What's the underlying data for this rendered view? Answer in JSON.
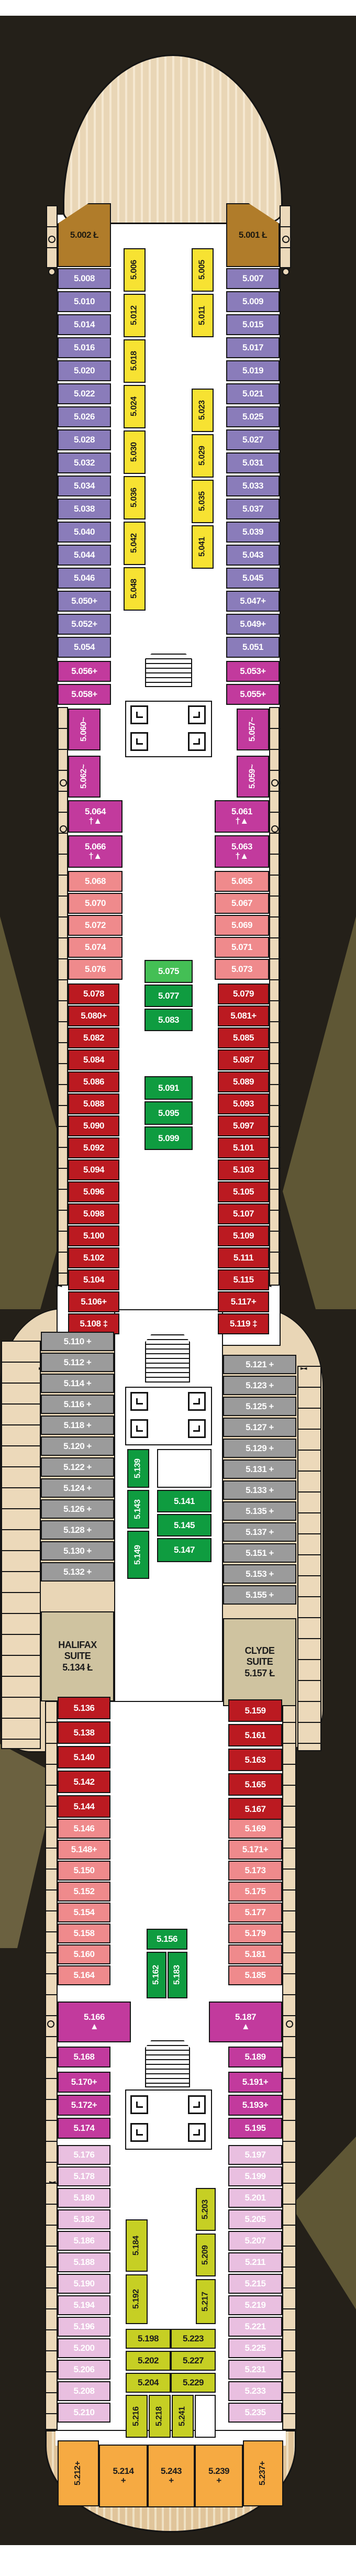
{
  "title": "Deck 5 cabin plan",
  "colors": {
    "background": "#242019",
    "background_art": "#5f5735",
    "hull_deck": "#e9d6b6",
    "hull_deck_stripe": "#f5e8d1",
    "suite_gold": "#b07c2a",
    "purple": "#8a7cba",
    "yellow": "#f7e232",
    "magenta": "#c23a9d",
    "salmon": "#ef8a8c",
    "red": "#bb1a21",
    "green_light": "#44bf55",
    "green": "#0f9c40",
    "gray": "#9b9b9b",
    "suite_beige": "#cfc3a0",
    "pink": "#e9bfe0",
    "chartreuse": "#c6cf24",
    "orange": "#f6aa42"
  },
  "symbols": {
    "lift_accessible": "Ł",
    "plus": "+",
    "tilde": "~",
    "dagger_triangle": "†▲",
    "triangle": "▲",
    "double_dagger": "‡"
  },
  "groups": {
    "brownL": {
      "cat": "brown",
      "items": [
        "5.002 Ł"
      ]
    },
    "brownR": {
      "cat": "brown",
      "items": [
        "5.001 Ł"
      ]
    },
    "yellowL": {
      "cat": "yellow",
      "items": [
        "5.006",
        "5.012",
        "5.018",
        "5.024",
        "5.030",
        "5.036",
        "5.042",
        "5.048"
      ]
    },
    "yellowR": {
      "cat": "yellow",
      "items": [
        "5.005",
        "5.011",
        "5.023",
        "5.029",
        "5.035",
        "5.041"
      ]
    },
    "purpleL": {
      "cat": "purple",
      "items": [
        "5.008",
        "5.010",
        "5.014",
        "5.016",
        "5.020",
        "5.022",
        "5.026",
        "5.028",
        "5.032",
        "5.034",
        "5.038",
        "5.040",
        "5.044",
        "5.046",
        "5.050+",
        "5.052+",
        "5.054"
      ]
    },
    "purpleR": {
      "cat": "purple",
      "items": [
        "5.007",
        "5.009",
        "5.015",
        "5.017",
        "5.019",
        "5.021",
        "5.025",
        "5.027",
        "5.031",
        "5.033",
        "5.037",
        "5.039",
        "5.043",
        "5.045",
        "5.047+",
        "5.049+",
        "5.051"
      ]
    },
    "mag1aL": {
      "cat": "magenta",
      "items": [
        "5.056+",
        "5.058+"
      ]
    },
    "mag1aR": {
      "cat": "magenta",
      "items": [
        "5.053+",
        "5.055+"
      ]
    },
    "mag1bL": {
      "cat": "magenta",
      "items": [
        "5.060~",
        "5.062~"
      ]
    },
    "mag1bR": {
      "cat": "magenta",
      "items": [
        "5.057~",
        "5.059~"
      ]
    },
    "mag1cL": {
      "cat": "magenta",
      "items": [
        "5.064\n†▲",
        "5.066\n†▲"
      ]
    },
    "mag1cR": {
      "cat": "magenta",
      "items": [
        "5.061\n†▲",
        "5.063\n†▲"
      ]
    },
    "sal1L": {
      "cat": "salmon",
      "items": [
        "5.068",
        "5.070",
        "5.072",
        "5.074",
        "5.076"
      ]
    },
    "sal1R": {
      "cat": "salmon",
      "items": [
        "5.065",
        "5.067",
        "5.069",
        "5.071",
        "5.073"
      ]
    },
    "red1L": {
      "cat": "red",
      "items": [
        "5.078",
        "5.080+",
        "5.082",
        "5.084",
        "5.086",
        "5.088",
        "5.090",
        "5.092",
        "5.094",
        "5.096",
        "5.098",
        "5.100",
        "5.102",
        "5.104",
        "5.106+",
        "5.108 ‡"
      ]
    },
    "red1R": {
      "cat": "red",
      "items": [
        "5.079",
        "5.081+",
        "5.085",
        "5.087",
        "5.089",
        "5.093",
        "5.097",
        "5.101",
        "5.103",
        "5.105",
        "5.107",
        "5.109",
        "5.111",
        "5.115",
        "5.117+",
        "5.119 ‡"
      ]
    },
    "green1a": {
      "cat": "greenl",
      "items": [
        "5.075"
      ]
    },
    "green1b": {
      "cat": "green",
      "items": [
        "5.077",
        "5.083"
      ]
    },
    "green1c": {
      "cat": "green",
      "items": [
        "5.091",
        "5.095",
        "5.099"
      ]
    },
    "grayL": {
      "cat": "gray",
      "items": [
        "5.110 +",
        "5.112 +",
        "5.114 +",
        "5.116 +",
        "5.118 +",
        "5.120 +",
        "5.122 +",
        "5.124 +",
        "5.126 +",
        "5.128 +",
        "5.130 +",
        "5.132 +"
      ]
    },
    "grayR": {
      "cat": "gray",
      "items": [
        "5.121 +",
        "5.123 +",
        "5.125 +",
        "5.127 +",
        "5.129 +",
        "5.131 +",
        "5.133 +",
        "5.135 +",
        "5.137 +",
        "5.151 +",
        "5.153 +",
        "5.155 +"
      ]
    },
    "green2L": {
      "cat": "green",
      "items": [
        "5.139",
        "5.143",
        "5.149"
      ]
    },
    "green2R": {
      "cat": "green",
      "items": [
        "5.141",
        "5.145",
        "5.147"
      ]
    },
    "suiteL": {
      "cat": "suite",
      "items": [
        "HALIFAX\nSUITE\n5.134 Ł"
      ]
    },
    "suiteR": {
      "cat": "suite",
      "items": [
        "CLYDE\nSUITE\n5.157 Ł"
      ]
    },
    "red2L": {
      "cat": "red",
      "items": [
        "5.136",
        "5.138",
        "5.140",
        "5.142",
        "5.144"
      ]
    },
    "red2R": {
      "cat": "red",
      "items": [
        "5.159",
        "5.161",
        "5.163",
        "5.165",
        "5.167"
      ]
    },
    "sal2L": {
      "cat": "salmon",
      "items": [
        "5.146",
        "5.148+",
        "5.150",
        "5.152",
        "5.154",
        "5.158",
        "5.160",
        "5.164"
      ]
    },
    "sal2R": {
      "cat": "salmon",
      "items": [
        "5.169",
        "5.171+",
        "5.173",
        "5.175",
        "5.177",
        "5.179",
        "5.181",
        "5.185"
      ]
    },
    "green3a": {
      "cat": "green",
      "items": [
        "5.156"
      ]
    },
    "green3b": {
      "cat": "green",
      "items": [
        "5.162"
      ]
    },
    "green3c": {
      "cat": "green",
      "items": [
        "5.183"
      ]
    },
    "mag2aL": {
      "cat": "magenta",
      "items": [
        "5.166\n▲"
      ]
    },
    "mag2aR": {
      "cat": "magenta",
      "items": [
        "5.187\n▲"
      ]
    },
    "mag2bL": {
      "cat": "magenta",
      "items": [
        "5.168",
        "5.170+",
        "5.172+",
        "5.174"
      ]
    },
    "mag2bR": {
      "cat": "magenta",
      "items": [
        "5.189",
        "5.191+",
        "5.193+",
        "5.195"
      ]
    },
    "pinkL": {
      "cat": "pink",
      "items": [
        "5.176",
        "5.178",
        "5.180",
        "5.182",
        "5.186",
        "5.188",
        "5.190",
        "5.194",
        "5.196",
        "5.200",
        "5.206",
        "5.208",
        "5.210"
      ]
    },
    "pinkR": {
      "cat": "pink",
      "items": [
        "5.197",
        "5.199",
        "5.201",
        "5.205",
        "5.207",
        "5.211",
        "5.215",
        "5.219",
        "5.221",
        "5.225",
        "5.231",
        "5.233",
        "5.235"
      ]
    },
    "chartL": {
      "cat": "chart",
      "items": [
        "5.184",
        "5.192"
      ]
    },
    "chartR": {
      "cat": "chart",
      "items": [
        "5.203",
        "5.209",
        "5.217"
      ]
    },
    "chartC1": {
      "cat": "chart",
      "items": [
        "5.198",
        "5.202",
        "5.204"
      ]
    },
    "chartC2": {
      "cat": "chart",
      "items": [
        "5.223",
        "5.227",
        "5.229"
      ]
    },
    "chartT1": {
      "cat": "chart",
      "items": [
        "5.216"
      ]
    },
    "chartT2": {
      "cat": "chart",
      "items": [
        "5.218"
      ]
    },
    "chartT3": {
      "cat": "chart",
      "items": [
        "5.241"
      ]
    },
    "orange1": {
      "cat": "orange",
      "items": [
        "5.212+"
      ]
    },
    "orange2": {
      "cat": "orange",
      "items": [
        "5.214\n+"
      ]
    },
    "orange3": {
      "cat": "orange",
      "items": [
        "5.243\n+"
      ]
    },
    "orange4": {
      "cat": "orange",
      "items": [
        "5.239\n+"
      ]
    },
    "orange5": {
      "cat": "orange",
      "items": [
        "5.237+"
      ]
    }
  }
}
